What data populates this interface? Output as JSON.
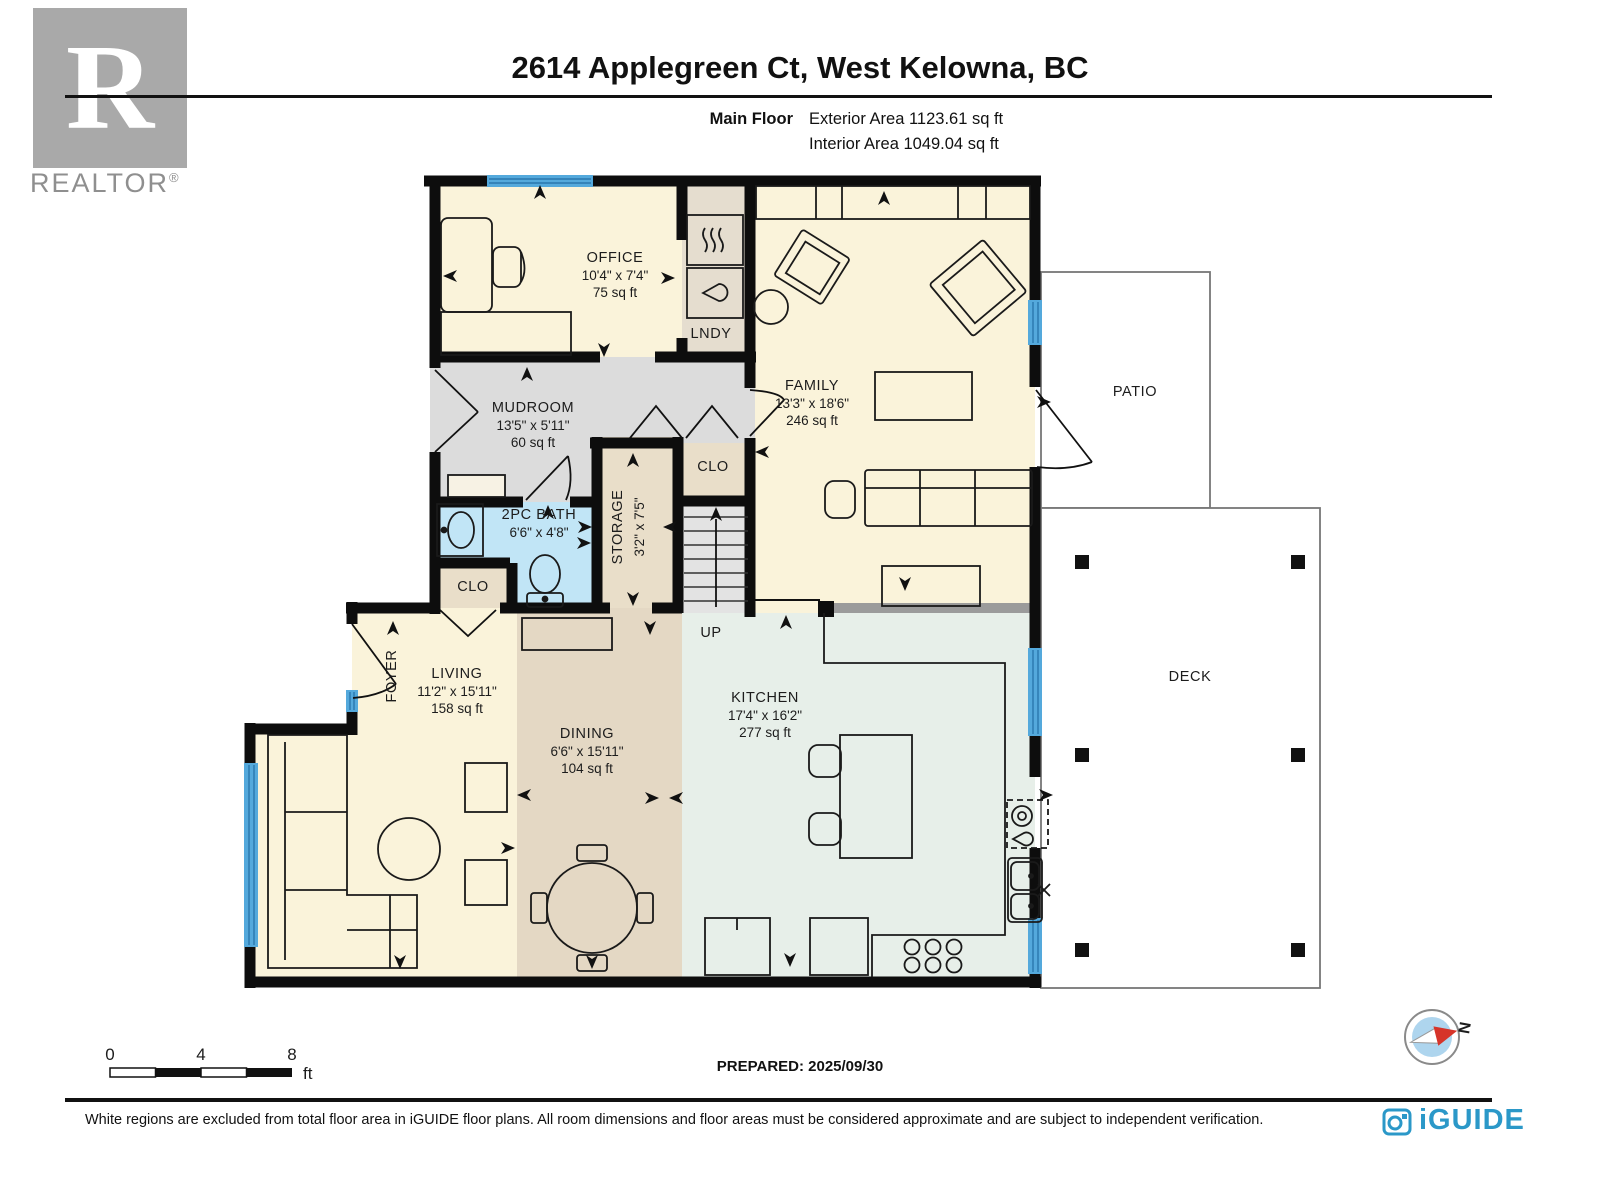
{
  "header": {
    "title": "2614 Applegreen Ct, West Kelowna, BC",
    "floor_label": "Main Floor",
    "exterior_area": "Exterior Area 1123.61 sq ft",
    "interior_area": "Interior Area 1049.04 sq ft",
    "realtor_initial": "R",
    "realtor_wordmark": "REALTOR",
    "registered_symbol": "®"
  },
  "rooms": {
    "office": {
      "name": "OFFICE",
      "dims": "10'4\" x 7'4\"",
      "area": "75 sq ft"
    },
    "lndy": {
      "name": "LNDY"
    },
    "family": {
      "name": "FAMILY",
      "dims": "13'3\" x 18'6\"",
      "area": "246 sq ft"
    },
    "mudroom": {
      "name": "MUDROOM",
      "dims": "13'5\" x 5'11\"",
      "area": "60 sq ft"
    },
    "clo_upper": {
      "name": "CLO"
    },
    "storage": {
      "name": "STORAGE",
      "dims": "3'2\" x 7'5\""
    },
    "bath": {
      "name": "2PC BATH",
      "dims": "6'6\" x 4'8\""
    },
    "clo_lower": {
      "name": "CLO"
    },
    "foyer": {
      "name": "FOYER"
    },
    "living": {
      "name": "LIVING",
      "dims": "11'2\" x 15'11\"",
      "area": "158 sq ft"
    },
    "dining": {
      "name": "DINING",
      "dims": "6'6\" x 15'11\"",
      "area": "104 sq ft"
    },
    "kitchen": {
      "name": "KITCHEN",
      "dims": "17'4\" x 16'2\"",
      "area": "277 sq ft"
    },
    "up_label": "UP",
    "patio": {
      "name": "PATIO"
    },
    "deck": {
      "name": "DECK"
    }
  },
  "scale_bar": {
    "tick0": "0",
    "tick4": "4",
    "tick8": "8",
    "unit": "ft"
  },
  "prepared": "PREPARED: 2025/09/30",
  "compass": {
    "north": "N"
  },
  "footer": {
    "disclaimer": "White regions are excluded from total floor area in iGUIDE floor plans. All room dimensions and floor areas must be considered approximate and are subject to independent verification.",
    "brand": "iGUIDE"
  },
  "colors": {
    "wall": "#0d0d0d",
    "cream": "#faf3da",
    "tan": "#e4d8c4",
    "beige": "#e9dec9",
    "lndy_beige": "#e5ddcf",
    "mudroom_gray": "#dcdcdc",
    "stairs_gray": "#e3e3e3",
    "bath_blue": "#c1e5f6",
    "kitchen_mint": "#e7efe9",
    "window_blue": "#54a9dc",
    "window_stripe": "#2a77ad",
    "half_wall_gray": "#9b9b9b",
    "compass_red": "#d6342a",
    "compass_blue": "#aed5ee",
    "iguide_blue": "#2b98c8",
    "realtor_gray": "#a9a9a9"
  }
}
